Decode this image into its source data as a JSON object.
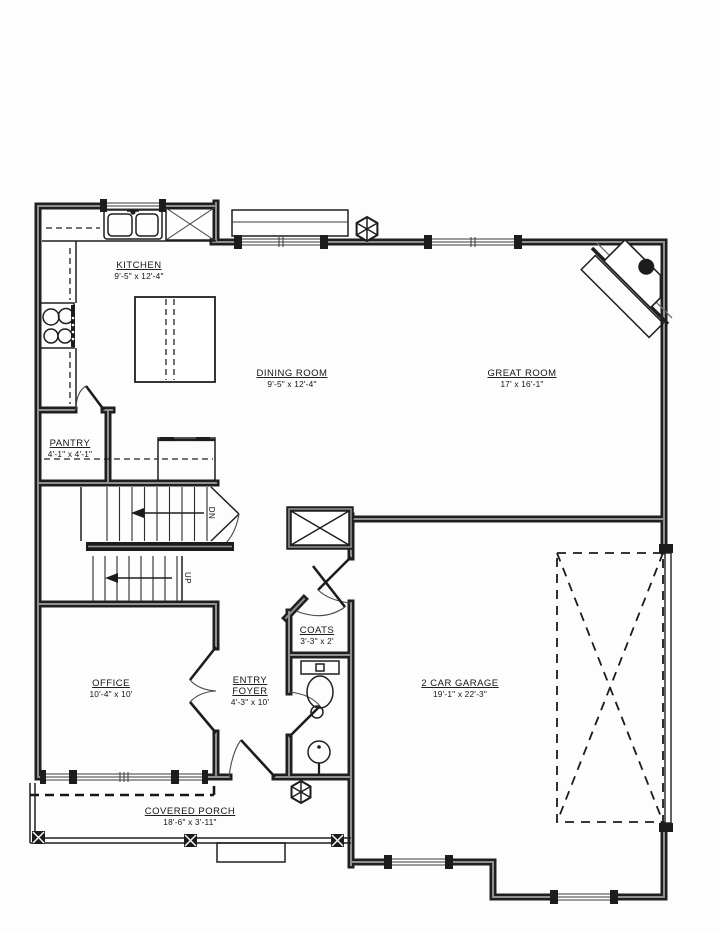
{
  "drawing": {
    "rooms": {
      "kitchen": {
        "label": "KITCHEN",
        "dims": "9'-5\" x 12'-4\""
      },
      "dining": {
        "label": "DINING ROOM",
        "dims": "9'-5\" x 12'-4\""
      },
      "great": {
        "label": "GREAT ROOM",
        "dims": "17' x 16'-1\""
      },
      "pantry": {
        "label": "PANTRY",
        "dims": "4'-1\" x 4'-1\""
      },
      "office": {
        "label": "OFFICE",
        "dims": "10'-4\" x 10'"
      },
      "entry": {
        "label_line1": "ENTRY",
        "label_line2": "FOYER",
        "dims": "4'-3\" x 10'"
      },
      "coats": {
        "label": "COATS",
        "dims": "3'-3\" x 2'"
      },
      "garage": {
        "label": "2 CAR GARAGE",
        "dims": "19'-1\" x 22'-3\""
      },
      "porch": {
        "label": "COVERED PORCH",
        "dims": "18'-6\" x 3'-11\""
      }
    },
    "stairs": {
      "down": "DN",
      "up": "UP"
    },
    "colors": {
      "ink": "#1c1c1c",
      "wall_core": "#909090",
      "paper": "#fdfdfd"
    }
  }
}
